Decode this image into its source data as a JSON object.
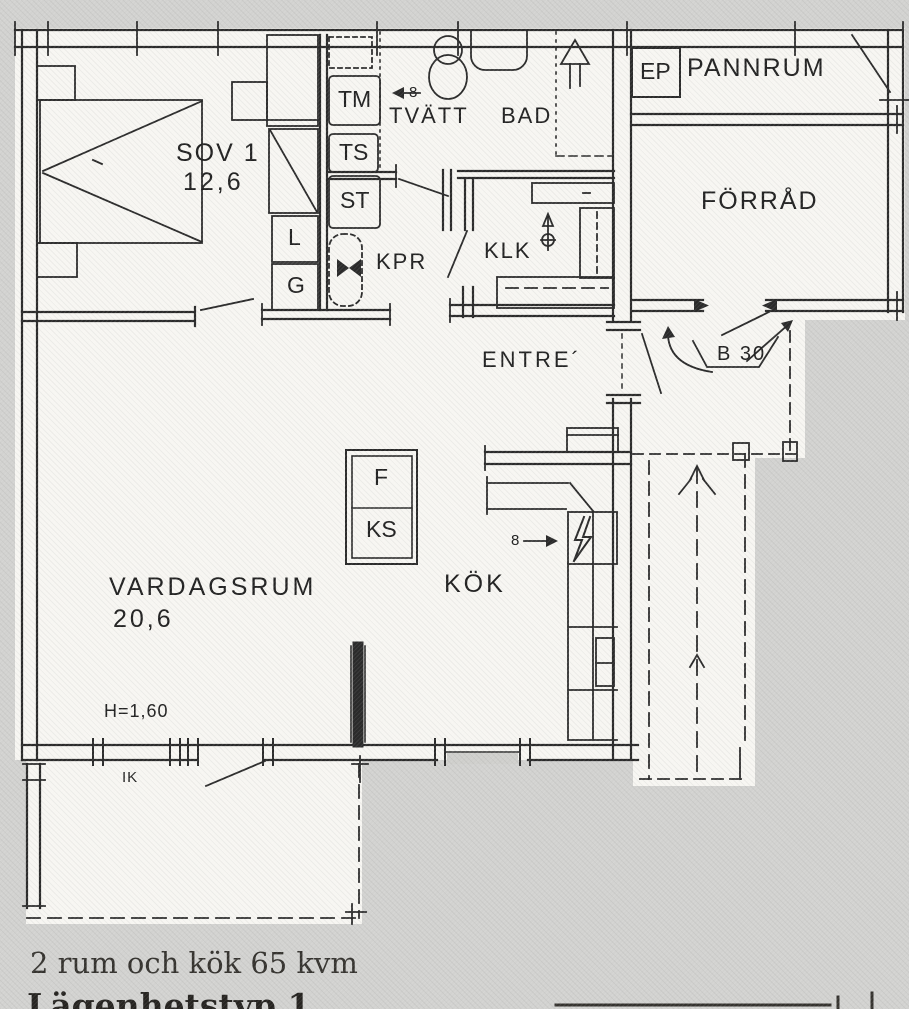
{
  "rooms": {
    "sov1": {
      "label": "SOV 1",
      "area": "12,6"
    },
    "tvatt": {
      "label": "TVÄTT"
    },
    "bad": {
      "label": "BAD"
    },
    "klk": {
      "label": "KLK"
    },
    "kpr": {
      "label": "KPR"
    },
    "entre": {
      "label": "ENTRE´"
    },
    "pannrum": {
      "label": "PANNRUM"
    },
    "forrad": {
      "label": "FÖRRÅD"
    },
    "kok": {
      "label": "KÖK"
    },
    "vardagsrum": {
      "label": "VARDAGSRUM",
      "area": "20,6"
    }
  },
  "cabinets": {
    "tm": "TM",
    "ts": "TS",
    "st": "ST",
    "linen": "L",
    "wardrobe": "G",
    "fridge": "F",
    "freezer": "KS",
    "ep": "EP"
  },
  "annotations": {
    "b30": "B 30",
    "ceiling_height": "H=1,60",
    "ik": "IK",
    "drain": "8"
  },
  "caption": {
    "line1": "2 rum och kök 65 kvm",
    "line2": "Lägenhetstyp 1"
  }
}
